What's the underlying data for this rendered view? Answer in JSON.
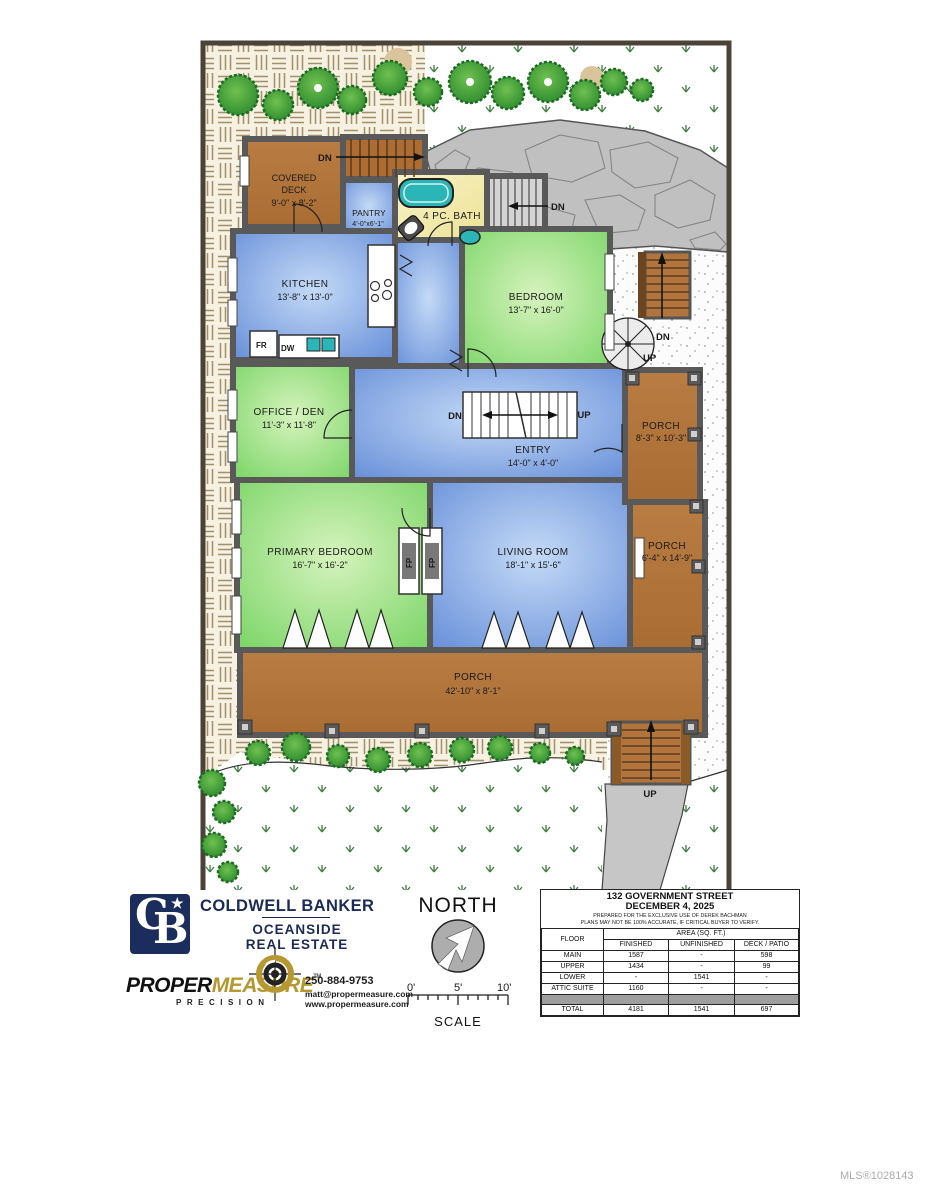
{
  "plan": {
    "labels": {
      "dn": "DN",
      "up": "UP"
    },
    "rooms": {
      "covered_deck": {
        "l1": "COVERED",
        "l2": "DECK",
        "dims": "9'-0\" x 8'-2\""
      },
      "pantry": {
        "name": "PANTRY",
        "dims": "4'-0\"x6'-1\""
      },
      "bath": {
        "name": "4 PC. BATH"
      },
      "kitchen": {
        "name": "KITCHEN",
        "dims": "13'-8\" x 13'-0\""
      },
      "bedroom": {
        "name": "BEDROOM",
        "dims": "13'-7\" x 16'-0\""
      },
      "office": {
        "name": "OFFICE / DEN",
        "dims": "11'-3\" x 11'-8\""
      },
      "entry": {
        "name": "ENTRY",
        "dims": "14'-0\" x 4'-0\""
      },
      "porch_upper": {
        "name": "PORCH",
        "dims": "8'-3\" x 10'-3\""
      },
      "porch_side": {
        "name": "PORCH",
        "dims": "6'-4\" x 14'-9\""
      },
      "porch_front": {
        "name": "PORCH",
        "dims": "42'-10\" x 8'-1\""
      },
      "primary": {
        "name": "PRIMARY BEDROOM",
        "dims": "16'-7\" x 16'-2\""
      },
      "living": {
        "name": "LIVING ROOM",
        "dims": "18'-1\" x 15'-6\""
      }
    },
    "fixtures": {
      "fr": "FR",
      "dw": "DW",
      "fp": "FP"
    }
  },
  "branding": {
    "coldwell": {
      "monogram_c": "C",
      "monogram_b": "B",
      "star": "★",
      "name": "COLDWELL BANKER",
      "line1": "OCEANSIDE",
      "line2": "REAL ESTATE"
    },
    "propermeasure": {
      "word1": "PROPER",
      "word2": "MEASURE",
      "tm": "TM",
      "tagline": "PRECISION",
      "phone": "250-884-9753",
      "email": "matt@propermeasure.com",
      "website": "www.propermeasure.com"
    }
  },
  "compass": {
    "north": "NORTH",
    "scale": "SCALE",
    "tick0": "0'",
    "tick5": "5'",
    "tick10": "10'"
  },
  "info_table": {
    "title": "132 GOVERNMENT STREET",
    "date": "DECEMBER 4, 2025",
    "note1": "PREPARED FOR THE EXCLUSIVE USE OF DEREK BACHMAN",
    "note2": "PLANS MAY NOT BE 100% ACCURATE, IF CRITICAL BUYER TO VERIFY.",
    "col_floor": "FLOOR",
    "col_area": "AREA (SQ. FT.)",
    "col_finished": "FINISHED",
    "col_unfinished": "UNFINISHED",
    "col_deck": "DECK / PATIO",
    "rows": [
      {
        "floor": "MAIN",
        "finished": "1587",
        "unfinished": "-",
        "deck": "598"
      },
      {
        "floor": "UPPER",
        "finished": "1434",
        "unfinished": "-",
        "deck": "99"
      },
      {
        "floor": "LOWER",
        "finished": "-",
        "unfinished": "1541",
        "deck": "-"
      },
      {
        "floor": "ATTIC SUITE",
        "finished": "1160",
        "unfinished": "-",
        "deck": "-"
      }
    ],
    "total": {
      "floor": "TOTAL",
      "finished": "4181",
      "unfinished": "1541",
      "deck": "697"
    }
  },
  "footer": {
    "mls": "MLS®1028143"
  },
  "colors": {
    "navy": "#1b2d5c",
    "gold": "#b5982f",
    "porch_brown": "#b0743c",
    "deck_brown": "#ad6c31",
    "room_blue": "#6b92da",
    "room_green": "#7ed66a",
    "bath_yellow": "#f3edb0",
    "fixture_teal": "#2ab6b6",
    "rock_gray": "#c0c0c0",
    "grass_green": "#3f7d3f"
  }
}
